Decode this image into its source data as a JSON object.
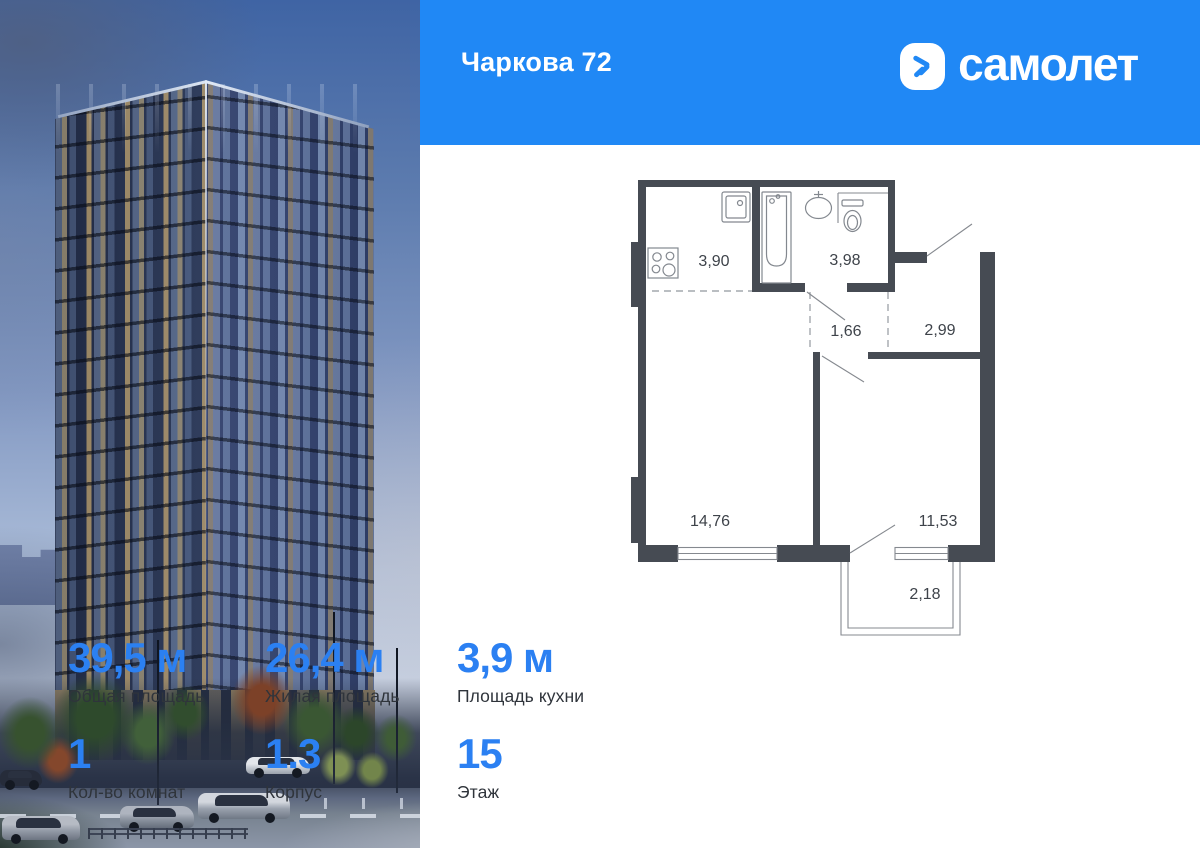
{
  "header": {
    "title": "Чаркова 72",
    "brand_name": "самолет",
    "bg_color": "#2088F5"
  },
  "floor_plan": {
    "wall_color": "#464B53",
    "rooms": {
      "kitchen": "3,90",
      "bathroom": "3,98",
      "hallway": "1,66",
      "corridor": "2,99",
      "living_room": "14,76",
      "bedroom": "11,53",
      "balcony": "2,18"
    }
  },
  "stats_primary": [
    {
      "value": "39,5 м",
      "label": "Общая площадь"
    },
    {
      "value": "26,4 м",
      "label": "Жилая площадь"
    },
    {
      "value": "3,9 м",
      "label": "Площадь кухни"
    }
  ],
  "stats_secondary": [
    {
      "value": "1",
      "label": "Кол-во комнат"
    },
    {
      "value": "1.3",
      "label": "Корпус"
    },
    {
      "value": "15",
      "label": "Этаж"
    }
  ],
  "accent_color": "#2B80F2"
}
